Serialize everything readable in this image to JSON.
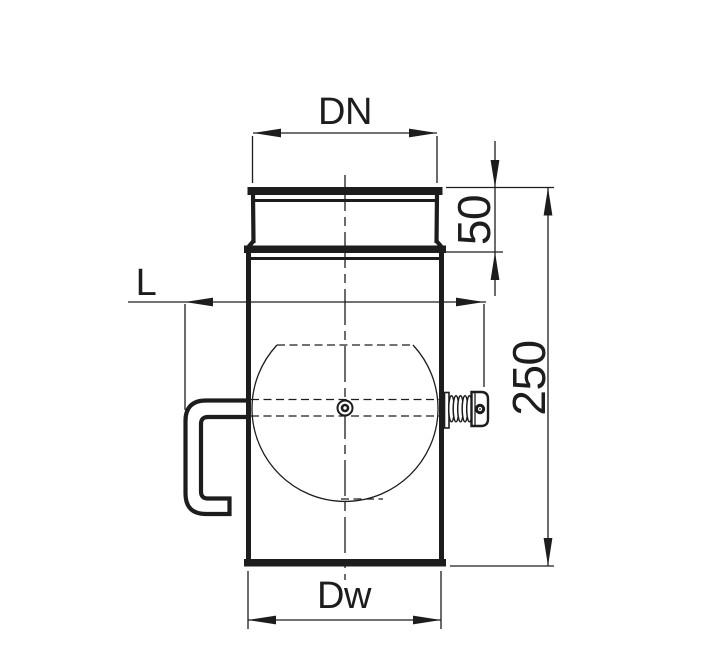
{
  "drawing": {
    "colors": {
      "ink": "#1d1d1d",
      "background": "#ffffff"
    },
    "dimensions": {
      "top_diameter_label": "DN",
      "collar_height_value": "50",
      "lever_length_label": "L",
      "overall_length_value": "250",
      "bottom_diameter_label": "Dw"
    }
  }
}
